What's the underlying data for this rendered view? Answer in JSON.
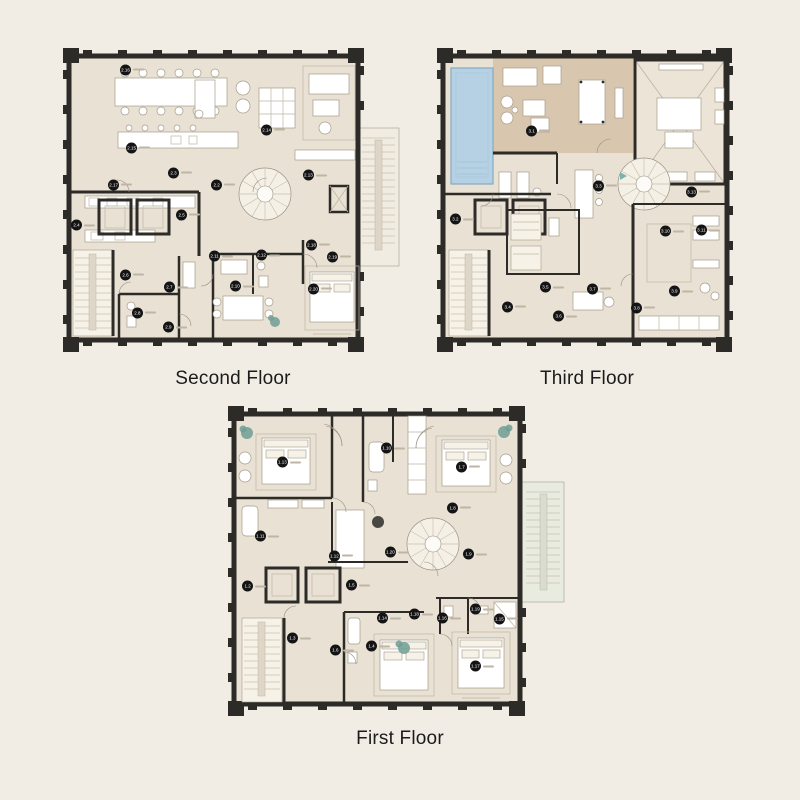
{
  "colors": {
    "background": "#f2ede4",
    "plan_fill": "#e9e1d3",
    "terrace_fill": "#d8c7ae",
    "pool_fill": "#b6d1e3",
    "wall": "#2c2b28",
    "marker_bg": "#141414",
    "marker_text": "#ffffff",
    "accent_teal": "#7db3aa",
    "label_text": "#1b1b1b"
  },
  "floors": [
    {
      "id": "second",
      "label": "Second Floor",
      "markers": [
        {
          "n": "2.16",
          "x": 20.3,
          "y": 8.2
        },
        {
          "n": "2.14",
          "x": 61.8,
          "y": 27.2
        },
        {
          "n": "2.15",
          "x": 22.1,
          "y": 32.9
        },
        {
          "n": "2.17",
          "x": 16.8,
          "y": 44.6
        },
        {
          "n": "2.3",
          "x": 34.4,
          "y": 40.8
        },
        {
          "n": "2.2",
          "x": 47.1,
          "y": 44.6
        },
        {
          "n": "2.13",
          "x": 74.1,
          "y": 41.5
        },
        {
          "n": "2.4",
          "x": 5.9,
          "y": 57.3
        },
        {
          "n": "2.5",
          "x": 36.8,
          "y": 54.1
        },
        {
          "n": "2.6",
          "x": 20.3,
          "y": 73.1
        },
        {
          "n": "2.8",
          "x": 23.8,
          "y": 85.1
        },
        {
          "n": "2.7",
          "x": 33.2,
          "y": 76.9
        },
        {
          "n": "2.9",
          "x": 32.9,
          "y": 89.6
        },
        {
          "n": "2.10",
          "x": 52.6,
          "y": 76.6
        },
        {
          "n": "2.11",
          "x": 46.5,
          "y": 67.1
        },
        {
          "n": "2.12",
          "x": 60.3,
          "y": 66.8
        },
        {
          "n": "2.18",
          "x": 75.0,
          "y": 63.6
        },
        {
          "n": "2.19",
          "x": 81.2,
          "y": 67.4
        },
        {
          "n": "2.20",
          "x": 75.6,
          "y": 77.5
        }
      ]
    },
    {
      "id": "third",
      "label": "Third Floor",
      "markers": [
        {
          "n": "3.1",
          "x": 33.7,
          "y": 27.5
        },
        {
          "n": "3.3",
          "x": 56.0,
          "y": 44.9
        },
        {
          "n": "3.13",
          "x": 87.0,
          "y": 46.8
        },
        {
          "n": "3.2",
          "x": 8.3,
          "y": 55.4
        },
        {
          "n": "3.4",
          "x": 25.7,
          "y": 83.2
        },
        {
          "n": "3.5",
          "x": 38.3,
          "y": 76.9
        },
        {
          "n": "3.6",
          "x": 42.7,
          "y": 86.1
        },
        {
          "n": "3.7",
          "x": 54.0,
          "y": 77.5
        },
        {
          "n": "3.8",
          "x": 68.7,
          "y": 83.5
        },
        {
          "n": "3.9",
          "x": 81.3,
          "y": 78.2
        },
        {
          "n": "3.10",
          "x": 78.3,
          "y": 59.2
        },
        {
          "n": "3.11",
          "x": 90.3,
          "y": 58.9
        }
      ]
    },
    {
      "id": "first",
      "label": "First Floor",
      "markers": [
        {
          "n": "1.13",
          "x": 17.7,
          "y": 18.8
        },
        {
          "n": "1.10",
          "x": 48.0,
          "y": 14.4
        },
        {
          "n": "1.7",
          "x": 69.8,
          "y": 20.3
        },
        {
          "n": "1.8",
          "x": 67.2,
          "y": 33.1
        },
        {
          "n": "1.11",
          "x": 11.3,
          "y": 41.9
        },
        {
          "n": "1.12",
          "x": 32.8,
          "y": 48.1
        },
        {
          "n": "1.20",
          "x": 49.1,
          "y": 46.9
        },
        {
          "n": "1.9",
          "x": 71.8,
          "y": 47.5
        },
        {
          "n": "1.2",
          "x": 7.6,
          "y": 57.5
        },
        {
          "n": "1.5",
          "x": 37.8,
          "y": 57.2
        },
        {
          "n": "1.14",
          "x": 46.8,
          "y": 67.5
        },
        {
          "n": "1.18",
          "x": 56.1,
          "y": 66.3
        },
        {
          "n": "1.16",
          "x": 64.2,
          "y": 67.5
        },
        {
          "n": "1.19",
          "x": 73.8,
          "y": 64.7
        },
        {
          "n": "1.15",
          "x": 80.8,
          "y": 67.8
        },
        {
          "n": "1.3",
          "x": 20.6,
          "y": 73.8
        },
        {
          "n": "1.6",
          "x": 33.1,
          "y": 77.5
        },
        {
          "n": "1.4",
          "x": 43.6,
          "y": 76.3
        },
        {
          "n": "1.17",
          "x": 73.8,
          "y": 82.5
        }
      ]
    }
  ]
}
